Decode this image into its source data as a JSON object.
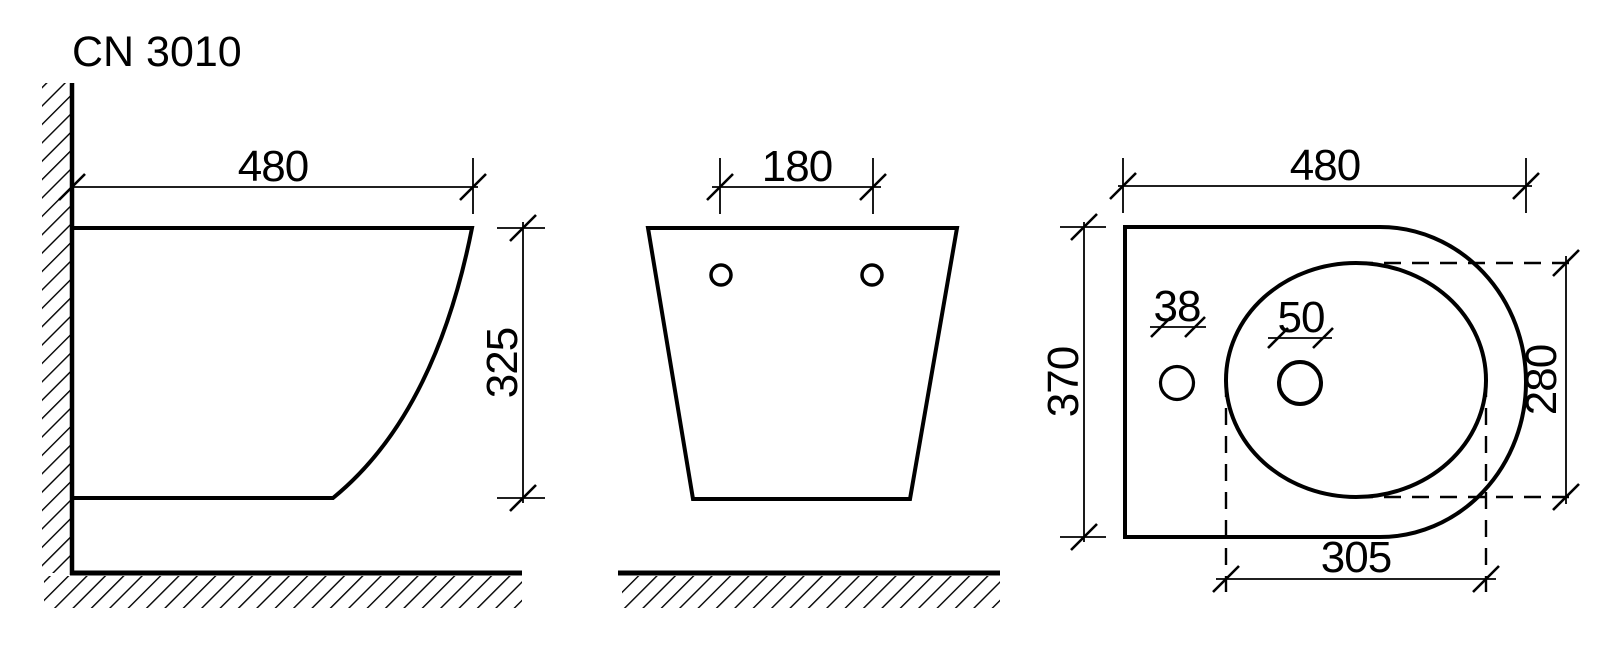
{
  "title": "CN 3010",
  "colors": {
    "line": "#000000",
    "background": "#ffffff"
  },
  "views": {
    "side": {
      "label": "side-view",
      "width_mm": "480",
      "height_mm": "325"
    },
    "front": {
      "label": "front-view",
      "hole_spacing_mm": "180"
    },
    "top": {
      "label": "top-view",
      "length_mm": "480",
      "depth_mm": "370",
      "mount_hole_diameter_mm": "38",
      "faucet_hole_diameter_mm": "50",
      "bowl_width_mm": "280",
      "bowl_length_mm": "305"
    }
  }
}
